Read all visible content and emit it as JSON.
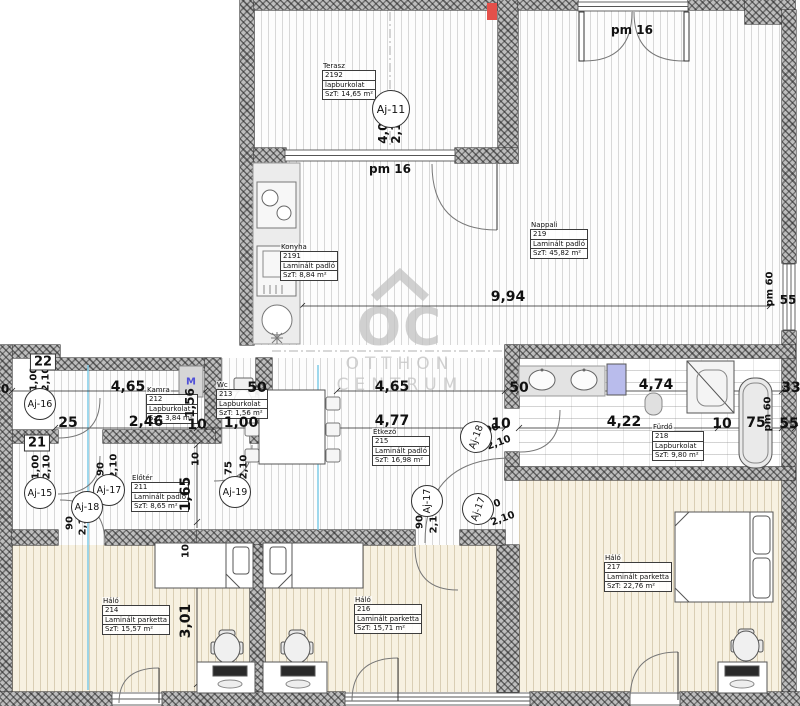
{
  "watermark": {
    "brand_letters": "OC",
    "line1": "OTTHON",
    "line2": "CENTRUM"
  },
  "rooms": [
    {
      "name": "Terasz",
      "number": "2192",
      "floor": "lapburkolat",
      "area": "SzT: 14,65 m²"
    },
    {
      "name": "Konyha",
      "number": "2191",
      "floor": "Laminált padló",
      "area": "SzT: 8,84 m²"
    },
    {
      "name": "Nappali",
      "number": "219",
      "floor": "Laminált padló",
      "area": "SzT: 45,82 m²"
    },
    {
      "name": "Kamra",
      "number": "212",
      "floor": "Lapburkolat",
      "area": "SzT: 3,84 m²"
    },
    {
      "name": "Wc",
      "number": "213",
      "floor": "Lapburkolat",
      "area": "SzT: 1,56 m²"
    },
    {
      "name": "Előtér",
      "number": "211",
      "floor": "Laminált padló",
      "area": "SzT: 8,65 m²"
    },
    {
      "name": "Étkező",
      "number": "215",
      "floor": "Laminált padló",
      "area": "SzT: 16,98 m²"
    },
    {
      "name": "Fürdő",
      "number": "218",
      "floor": "Lapburkolat",
      "area": "SzT: 9,80 m²"
    },
    {
      "name": "Háló",
      "number": "214",
      "floor": "Laminált parketta",
      "area": "SzT: 15,57 m²"
    },
    {
      "name": "Háló",
      "number": "216",
      "floor": "Laminált parketta",
      "area": "SzT: 15,71 m²"
    },
    {
      "name": "Háló",
      "number": "217",
      "floor": "Laminált parketta",
      "area": "SzT: 22,76 m²"
    }
  ],
  "doors": {
    "aj11": "Aj-11",
    "aj15": "Aj-15",
    "aj16": "Aj-16",
    "aj17": "Aj-17",
    "aj18": "Aj-18",
    "aj19": "Aj-19"
  },
  "dims": {
    "d0": "0",
    "d10": "10",
    "d25": "25",
    "d33": "33",
    "d50": "50",
    "d55": "55",
    "d75": "75",
    "d90": "90",
    "d100": "1,00",
    "d156": "1,56",
    "d165": "1,65",
    "d210": "2,10",
    "d246": "2,46",
    "d301": "3,01",
    "d400": "4,00",
    "d422": "4,22",
    "d465": "4,65",
    "d474": "4,74",
    "d477": "4,77",
    "d994": "9,94",
    "n21": "21",
    "n22": "22",
    "pm16": "pm 16",
    "pm60": "pm 60",
    "washer": "M"
  },
  "colors": {
    "wall_hatch": "#bdbdbd",
    "accent_blue": "#b9bcec",
    "washer_letter": "#5050d8",
    "section_line": "#7ecbe8",
    "red_mark": "#e4504a",
    "watermark_gray": "#c2c2c2",
    "bedroom_floor": "#f7f1e1"
  }
}
